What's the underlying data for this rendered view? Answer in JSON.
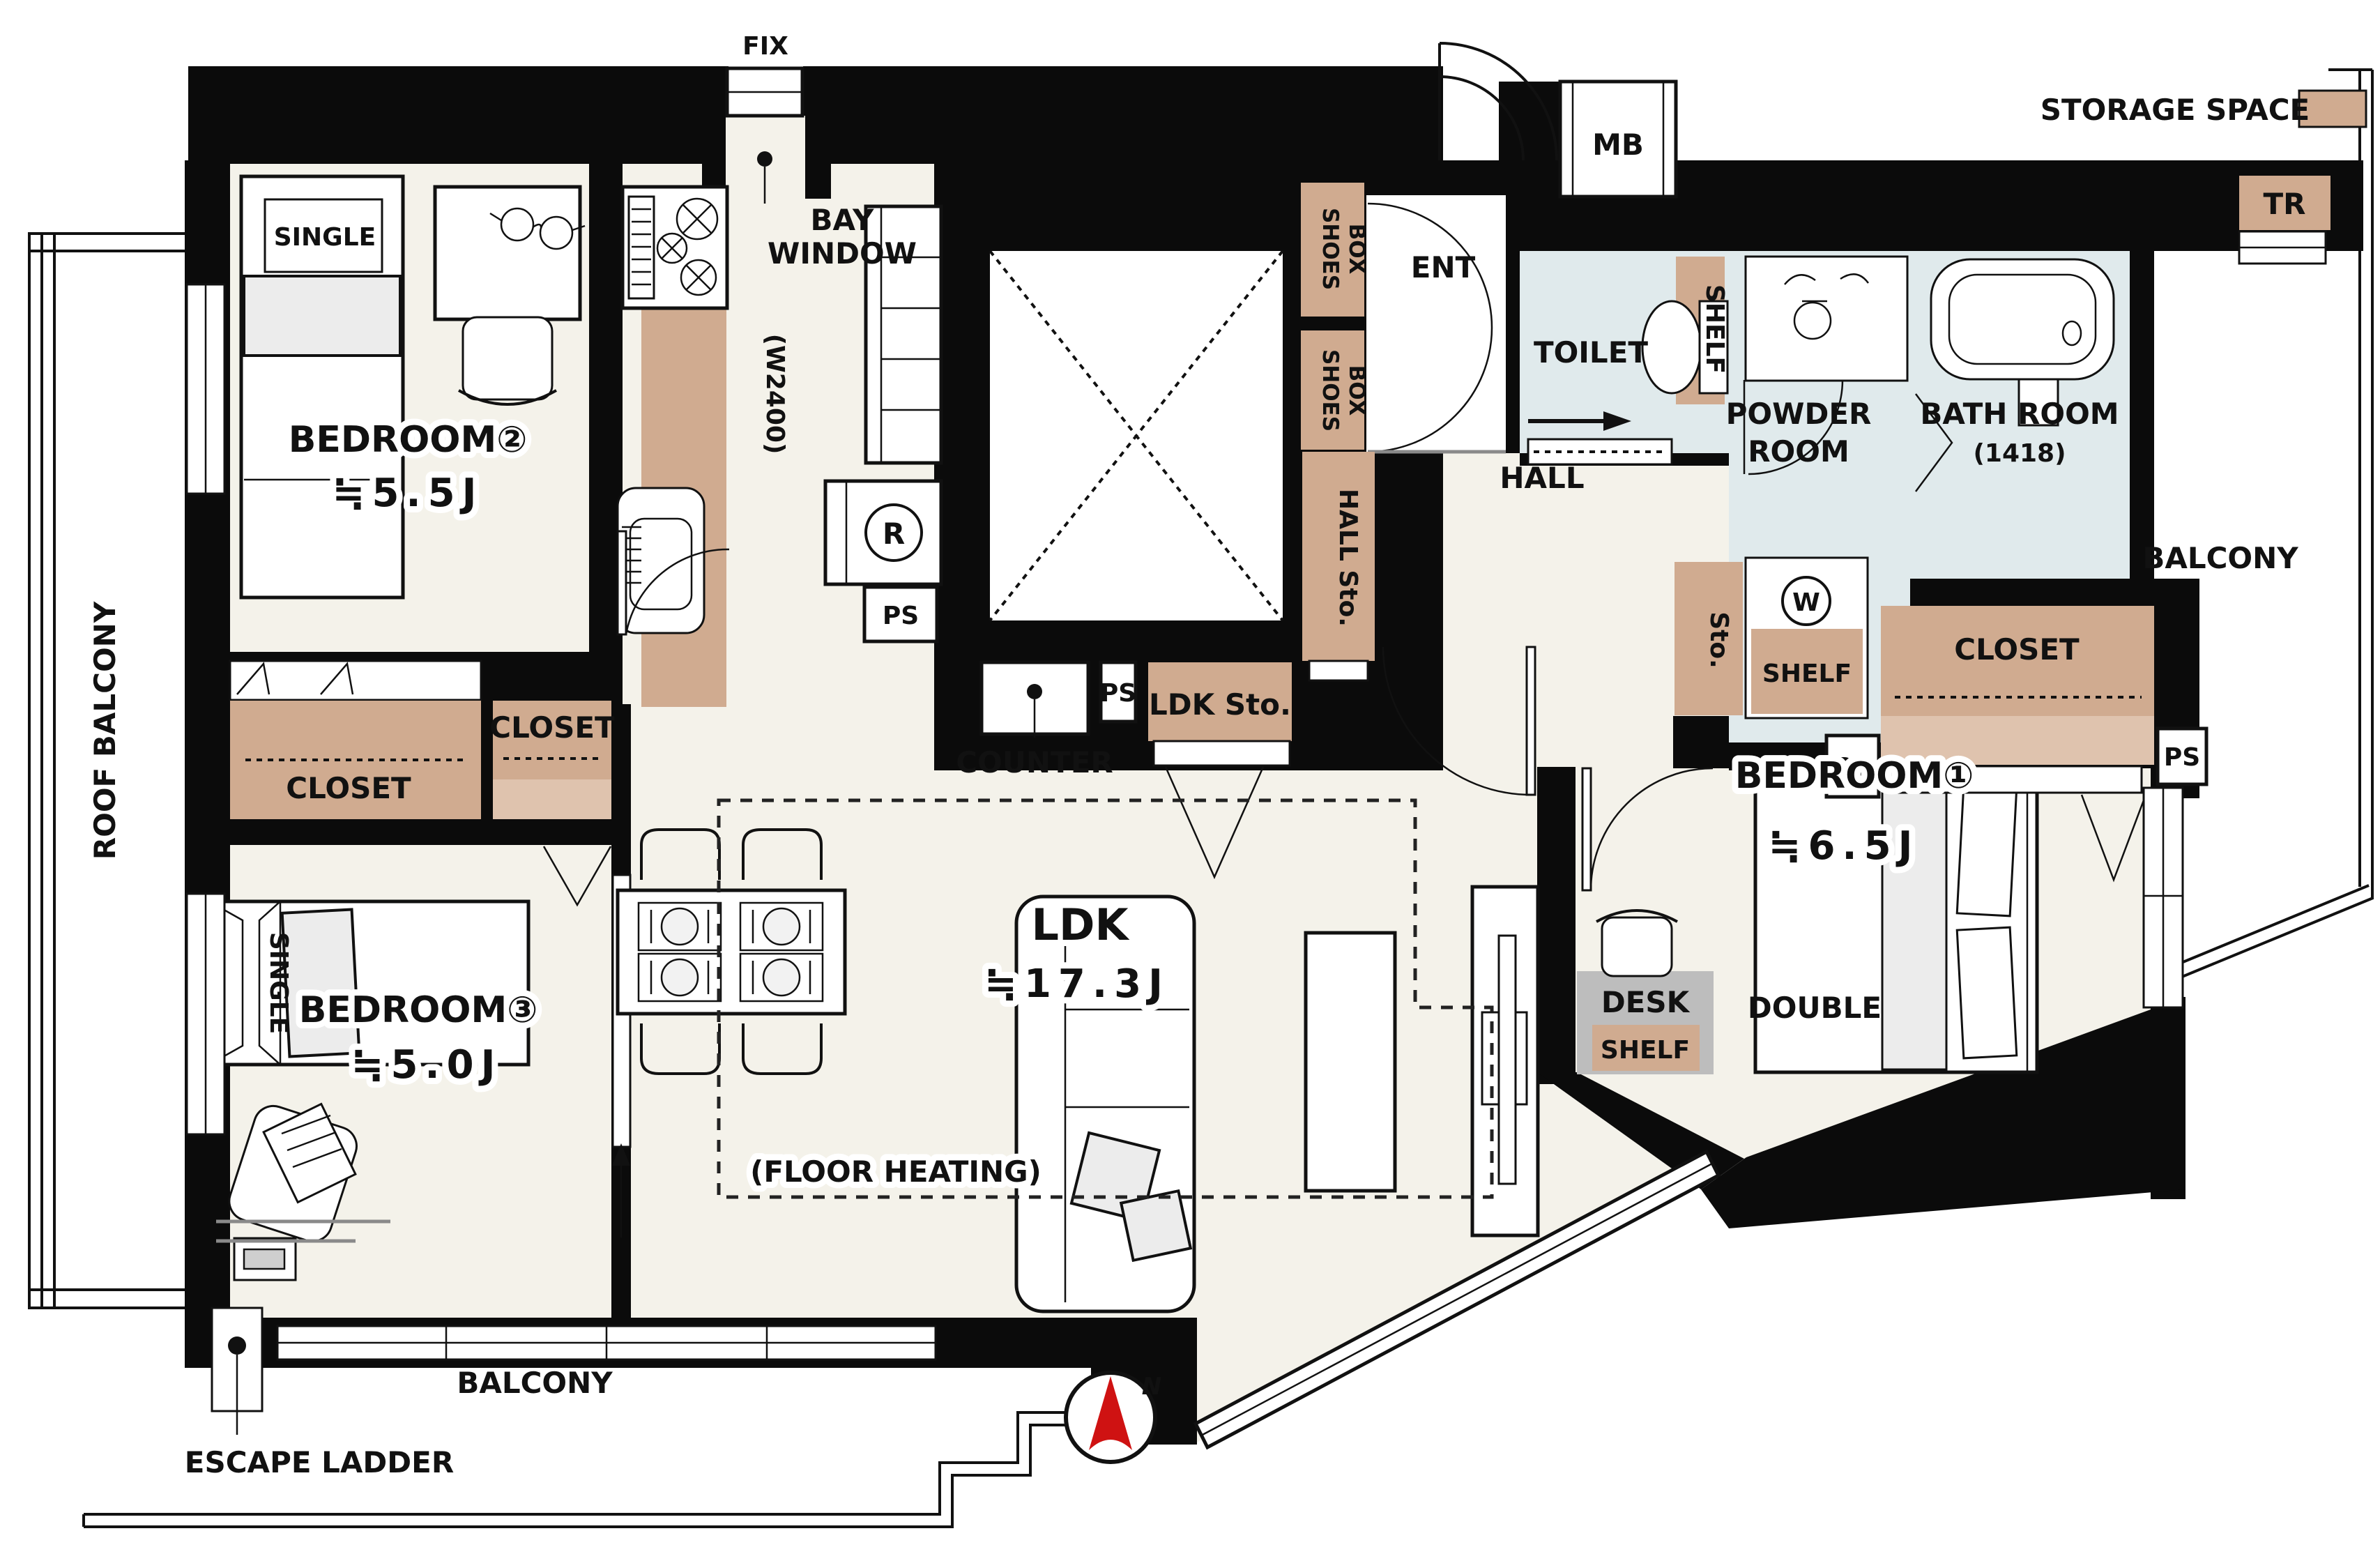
{
  "colors": {
    "storage_tan": "#d0ab90",
    "storage_tan_light": "#dfc3ae",
    "wet_room_blue": "#e0eaec",
    "floor_cream": "#f4f2ea",
    "wall_black": "#0b0b0b",
    "desk_gray": "#bdbdbd",
    "compass_red": "#cf1212"
  },
  "legend": {
    "storage_space": "STORAGE SPACE"
  },
  "compass": {
    "north": "N"
  },
  "plan": {
    "fix": "FIX",
    "bay_window": [
      "BAY",
      "WINDOW"
    ],
    "kitchen_width": "(W2400)",
    "mb": "MB",
    "tr": "TR",
    "ent": "ENT",
    "shoes_box": [
      "SHOES",
      "BOX"
    ],
    "toilet": "TOILET",
    "toilet_shelf": "SHELF",
    "powder_room": [
      "POWDER",
      "ROOM"
    ],
    "washer": "W",
    "powder_sto": "Sto.",
    "powder_shelf": "SHELF",
    "bath_room": "BATH ROOM",
    "bath_size": "(1418)",
    "hall": "HALL",
    "hall_sto": "HALL Sto.",
    "ldk_sto": "LDK Sto.",
    "counter": "COUNTER",
    "ps": "PS",
    "closet": "CLOSET",
    "balcony": "BALCONY",
    "roof_balcony": "ROOF BALCONY",
    "refrigerator": "R",
    "floor_heating": "(FLOOR HEATING)",
    "escape_ladder": "ESCAPE LADDER",
    "desk": "DESK",
    "desk_shelf": "SHELF",
    "ldk": {
      "name": "LDK",
      "size": "≒17.3J"
    },
    "bedroom1": {
      "name": "BEDROOM①",
      "size": "≒6.5J",
      "bed": "DOUBLE"
    },
    "bedroom2": {
      "name": "BEDROOM②",
      "size": "≒5.5J",
      "bed": "SINGLE"
    },
    "bedroom3": {
      "name": "BEDROOM③",
      "size": "≒5.0J",
      "bed": "SINGLE"
    }
  }
}
